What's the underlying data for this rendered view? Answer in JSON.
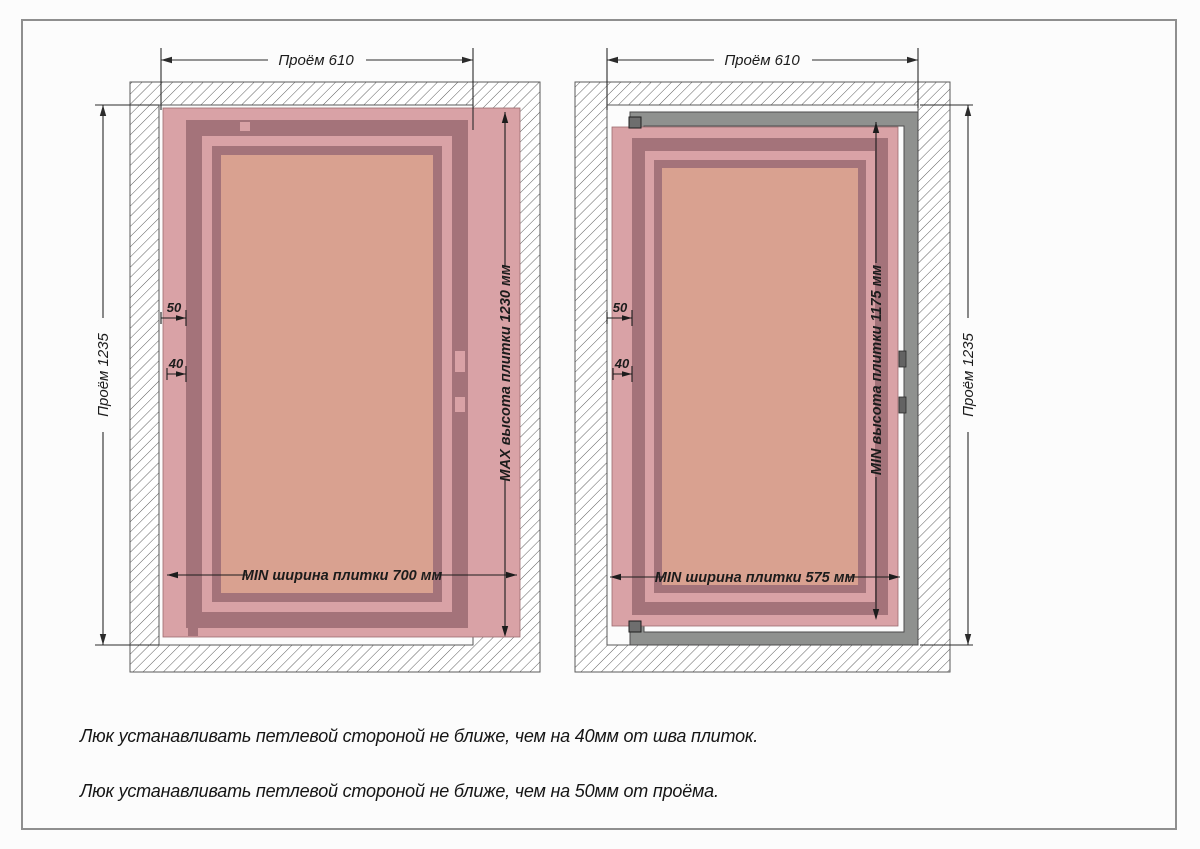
{
  "title": "Схема установки люка под плитку",
  "drawings": {
    "left": {
      "top_dim": "Проём 610",
      "side_dim": "Проём 1235",
      "height_dim": "MAX высота плитки 1230 мм",
      "width_dim": "MIN ширина плитки 700 мм",
      "offset_opening": "50",
      "offset_seam": "40"
    },
    "right": {
      "top_dim": "Проём 610",
      "side_dim": "Проём 1235",
      "height_dim": "MIN высота плитки 1175 мм",
      "width_dim": "MIN ширина плитки 575 мм",
      "offset_opening": "50",
      "offset_seam": "40"
    }
  },
  "notes": {
    "line1": "Люк устанавливать петлевой стороной не ближе, чем на 40мм от шва плиток.",
    "line2": "Люк устанавливать петлевой стороной не ближе, чем на 50мм от проёма."
  },
  "colors": {
    "tile_pink": "#d9a2a6",
    "frame_mauve": "#a4737a",
    "tile_salmon": "#d9a190",
    "hatch_line": "#4f4f4f",
    "lyuk_gray": "#8f918f",
    "dim_line": "#2b2b2b",
    "page_border": "#8f8f8f"
  }
}
